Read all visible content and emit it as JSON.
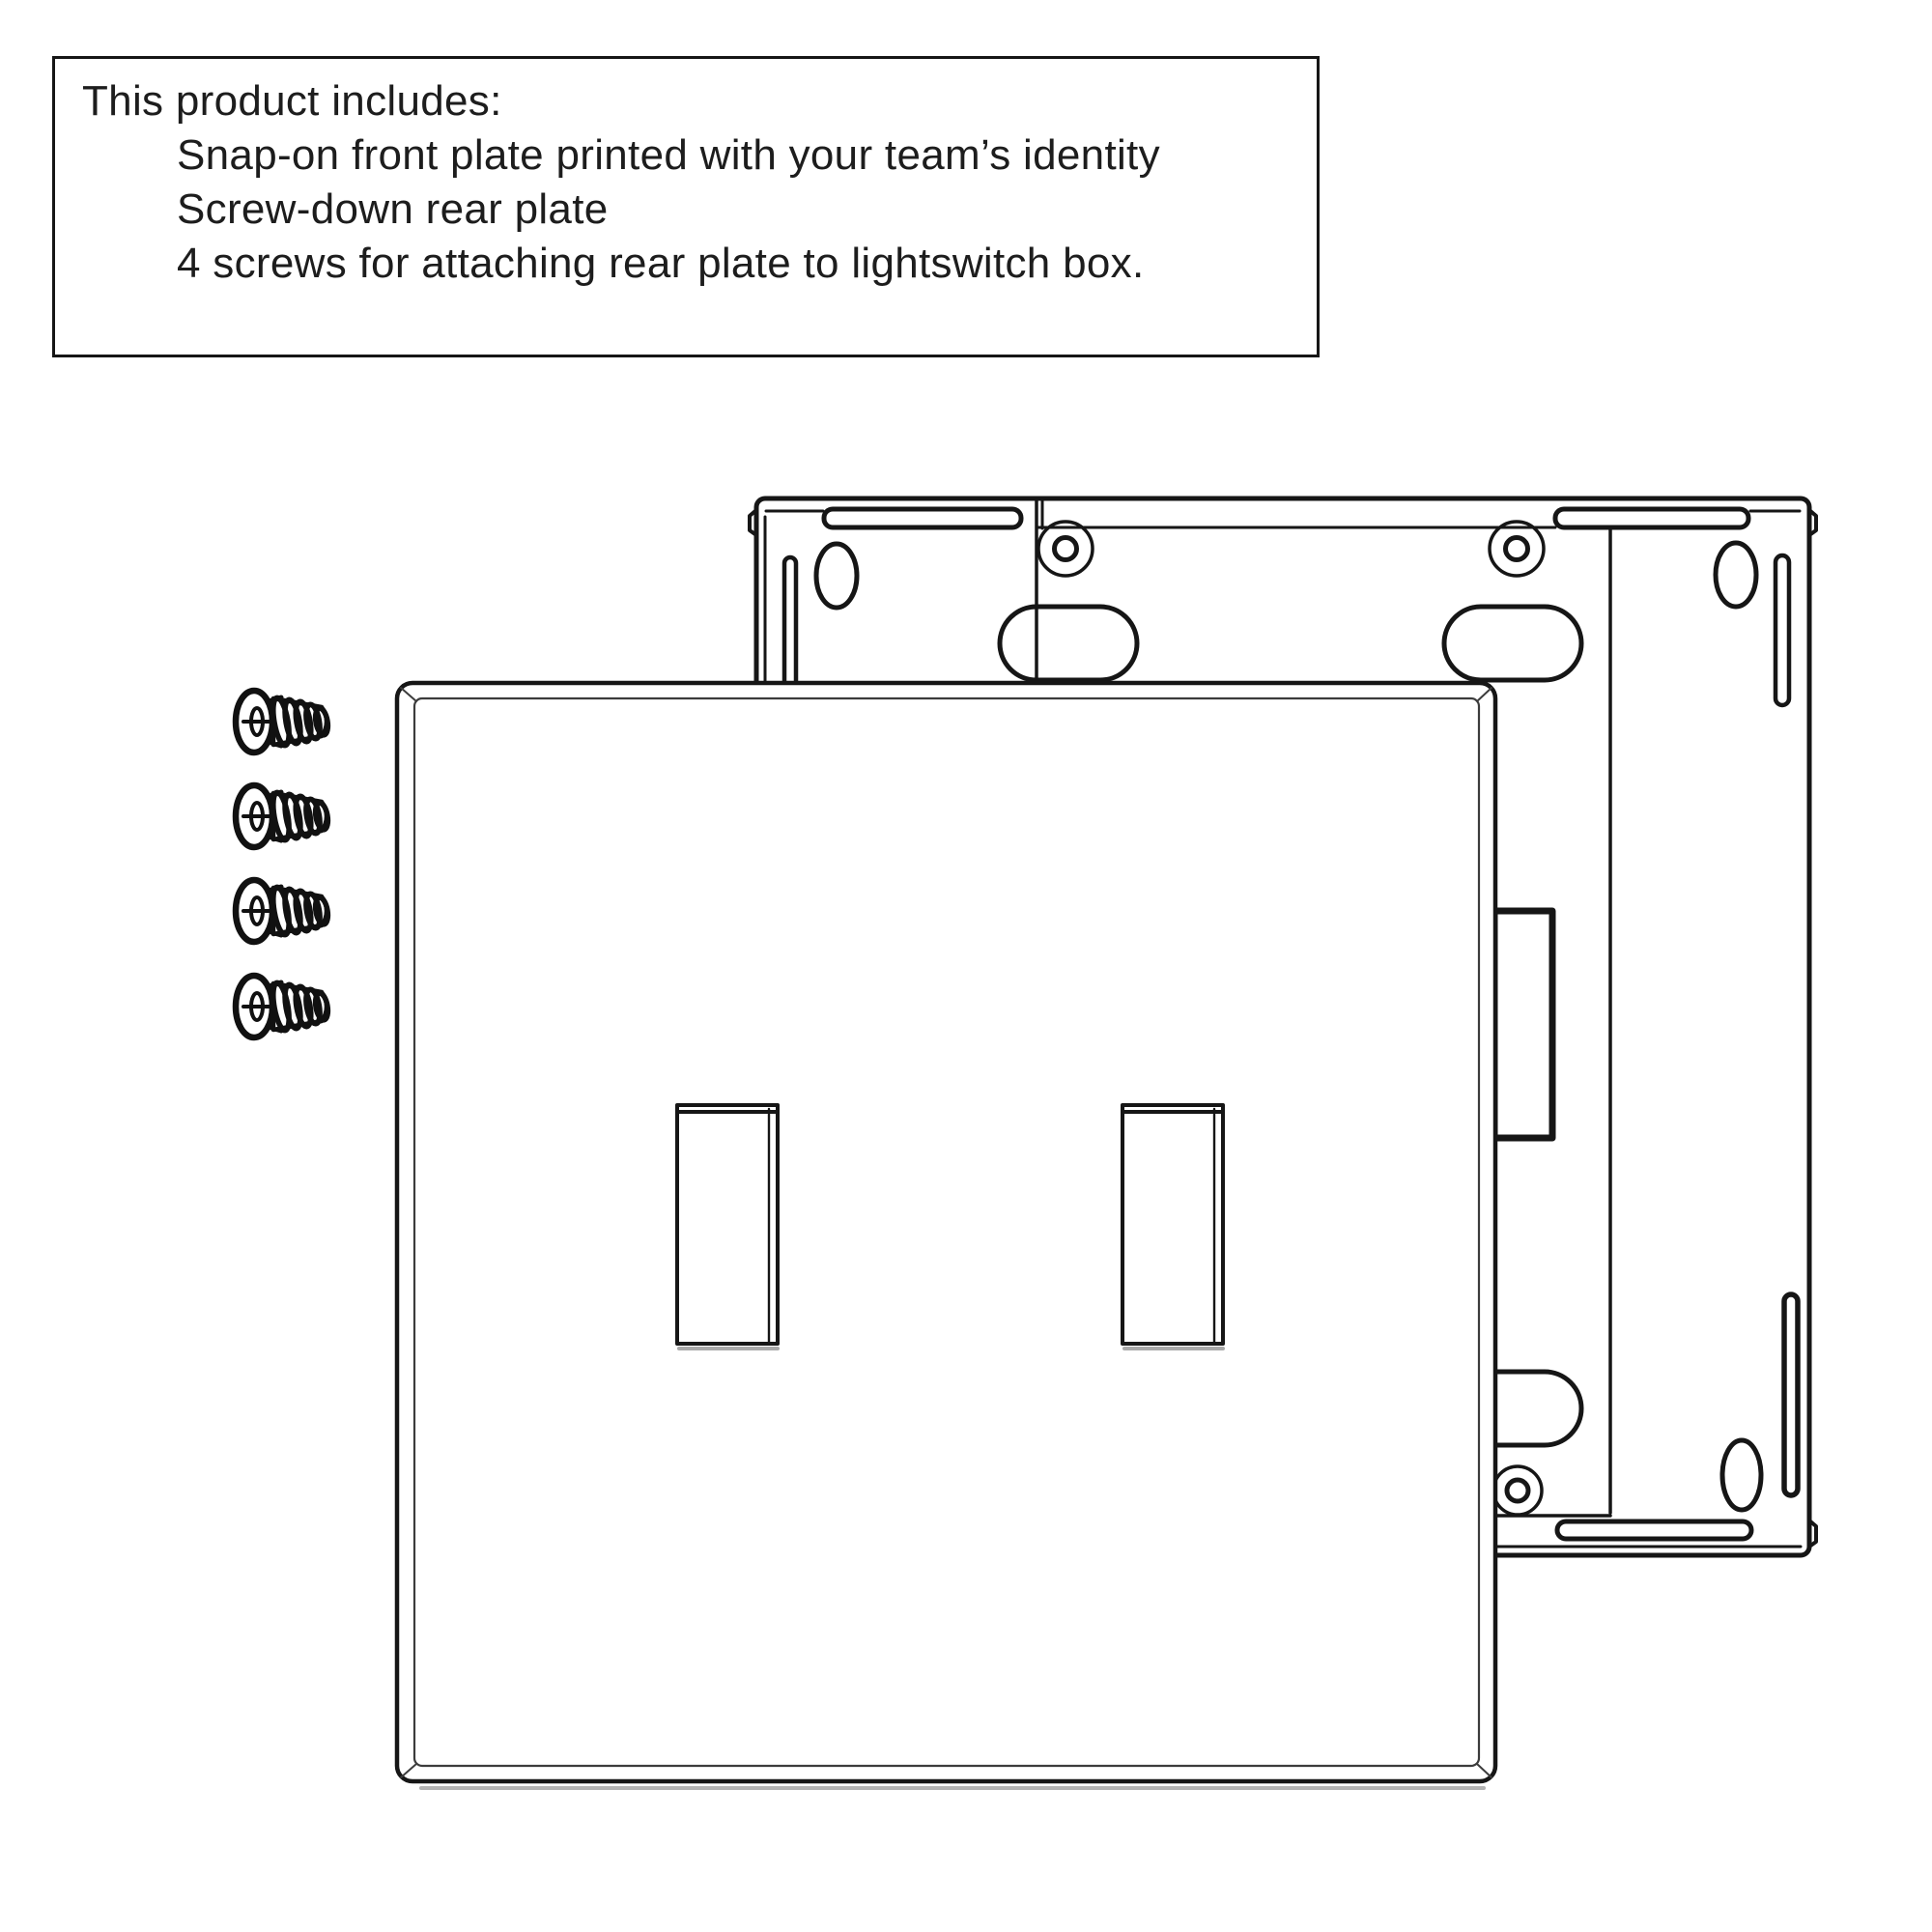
{
  "page": {
    "background_color": "#ffffff",
    "line_color": "#161616",
    "shadow_color": "#a9a9a9"
  },
  "product_info": {
    "title": "This product includes:",
    "items": [
      "Snap-on front plate printed with your team’s identity",
      "Screw-down rear plate",
      "4 screws for attaching rear plate to lightswitch box."
    ]
  },
  "diagram": {
    "screw_count": "4",
    "toggle_opening_count": "2"
  }
}
